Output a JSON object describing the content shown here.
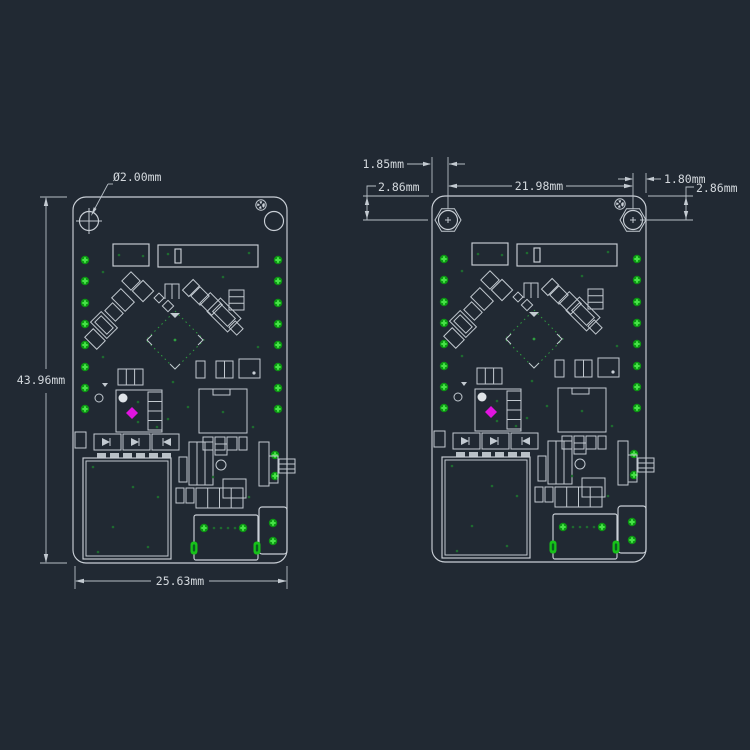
{
  "drawing": {
    "title": "PCB mechanical dimension drawing (two views)",
    "colors": {
      "background": "#212933",
      "line": "#c9cfd6",
      "pad_green": "#2ed12e",
      "marker_magenta": "#e014e0",
      "chip_dash_green": "#2f9e40"
    },
    "left_view": {
      "dims": {
        "hole_diameter": "Ø2.00mm",
        "board_height": "43.96mm",
        "board_width": "25.63mm"
      }
    },
    "right_view": {
      "dims": {
        "left_edge_to_hole": "1.85mm",
        "hole_to_hole": "21.98mm",
        "hole_to_right_edge": "1.80mm",
        "top_edge_to_hole_left": "2.86mm",
        "top_edge_to_hole_right": "2.86mm"
      }
    }
  }
}
